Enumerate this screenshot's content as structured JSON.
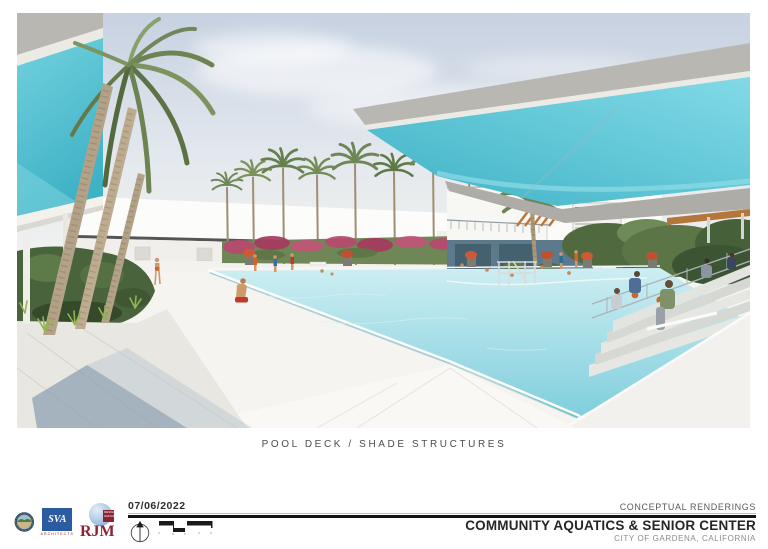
{
  "rendering": {
    "caption": "POOL DECK / SHADE STRUCTURES"
  },
  "titleblock": {
    "date": "07/06/2022",
    "series": "CONCEPTUAL RENDERINGS",
    "project": "COMMUNITY AQUATICS & SENIOR CENTER",
    "location": "CITY OF GARDENA, CALIFORNIA"
  },
  "logos": {
    "sva": {
      "name": "SVA",
      "tagline": "ARCHITECTS"
    },
    "rjm": {
      "name": "RJM",
      "tagline": "DESIGN GROUP"
    }
  },
  "colors": {
    "canopy_teal": "#58c4d4",
    "canopy_teal_deep": "#3fb2c6",
    "sky_top": "#c7d1e1",
    "pool_far": "#cdeef2",
    "pool_near": "#7fcedd",
    "foliage": "#6f8757",
    "bougainvillea": "#b84a6e",
    "slate_wall": "#5d7a8c",
    "rjm_red": "#8d2332",
    "sva_blue": "#2b5ca0"
  }
}
